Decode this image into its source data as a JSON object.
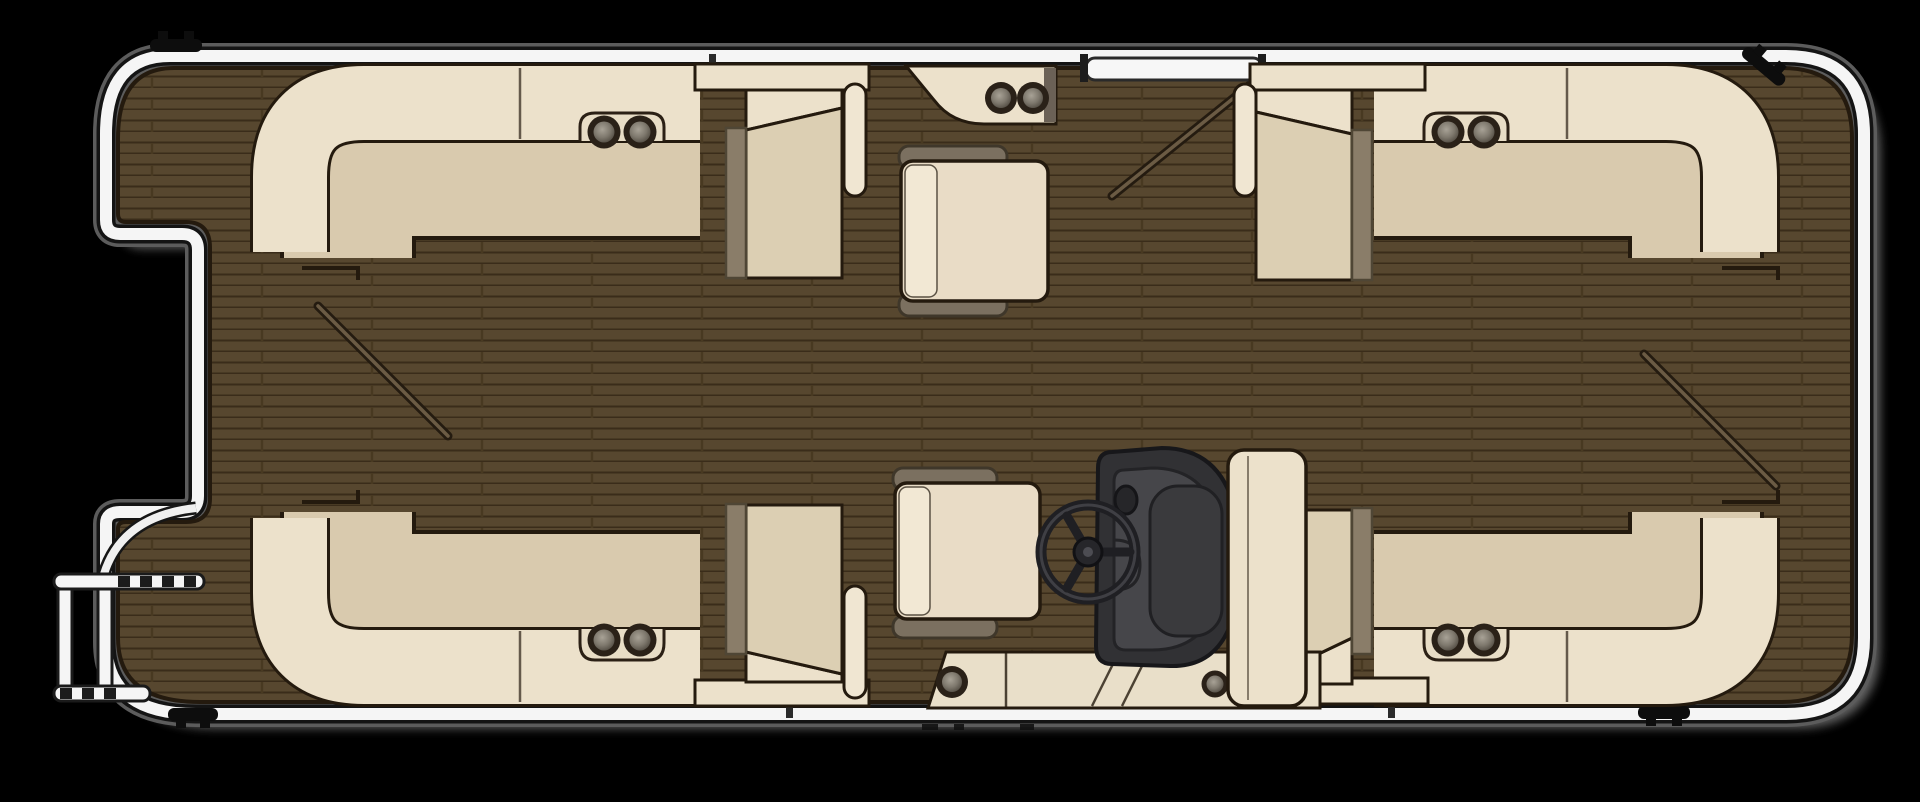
{
  "title": "Pontoon boat floor plan (top view)",
  "palette": {
    "background": "#000000",
    "deck_wood": "#57472f",
    "plank_line": "#3a2c1a",
    "rail_white": "#f5f5f5",
    "rail_shadow_gray": "#6e6e6e",
    "outline_dark": "#241a0e",
    "cushion_light": "#ece1cb",
    "cushion_tan": "#d9caae",
    "accent_taupe": "#8a7d69",
    "table_top": "#e9dcc6",
    "table_base_band": "#7b7060",
    "helm_dark": "#2f2f32",
    "helm_panel": "#46464a",
    "cleat_black": "#0d0d0d"
  },
  "components": {
    "hull": {
      "label": "pontoon deck with chrome perimeter rail"
    },
    "bow_gate": {
      "label": "bow boarding gate recess (port-forward notch)"
    },
    "boarding_ladder": {
      "label": "bow boarding ladder with rungs"
    },
    "port_gate": {
      "label": "port side gate with open-swing line"
    },
    "stern_gate": {
      "label": "stern gate swing line"
    },
    "bow_walk_swing": {
      "label": "bow gate swing line"
    },
    "lounge_port_bow": {
      "label": "port bow wraparound lounge",
      "cup_holders": 2
    },
    "lounge_starboard_bow": {
      "label": "starboard bow wraparound lounge",
      "cup_holders": 2
    },
    "lounge_port_aft": {
      "label": "port aft wraparound lounge",
      "cup_holders": 2
    },
    "lounge_starboard_aft": {
      "label": "starboard aft wraparound lounge",
      "cup_holders": 2
    },
    "chaise_port_bow": {
      "label": "port bow chaise end with armrest"
    },
    "chaise_starboard_bow": {
      "label": "starboard bow chaise end with armrest"
    },
    "chaise_port_aft": {
      "label": "port aft chaise end with armrest"
    },
    "chaise_starboard_aft": {
      "label": "starboard aft chaise end"
    },
    "bow_table": {
      "label": "forward removable table with base pads"
    },
    "aft_table": {
      "label": "aft removable table with base pads"
    },
    "top_cupholder_console": {
      "label": "port gate cup-holder console",
      "cup_holders": 2
    },
    "helm_bench": {
      "label": "helm step bench",
      "cup_holders": 2
    },
    "helm_console": {
      "label": "helm console (fiberglass, dark)"
    },
    "steering_wheel": {
      "label": "three-spoke steering wheel"
    },
    "captains_chair": {
      "label": "captain's chair"
    },
    "cleat_top_left": {
      "label": "mooring cleat"
    },
    "cleat_top_right": {
      "label": "mooring cleat"
    },
    "cleat_bottom_left": {
      "label": "mooring cleat"
    },
    "cleat_bottom_right": {
      "label": "mooring cleat"
    },
    "totals": {
      "cup_holders": 12,
      "cleats": 4,
      "lounges": 4,
      "tables": 2,
      "gates": 3
    }
  }
}
